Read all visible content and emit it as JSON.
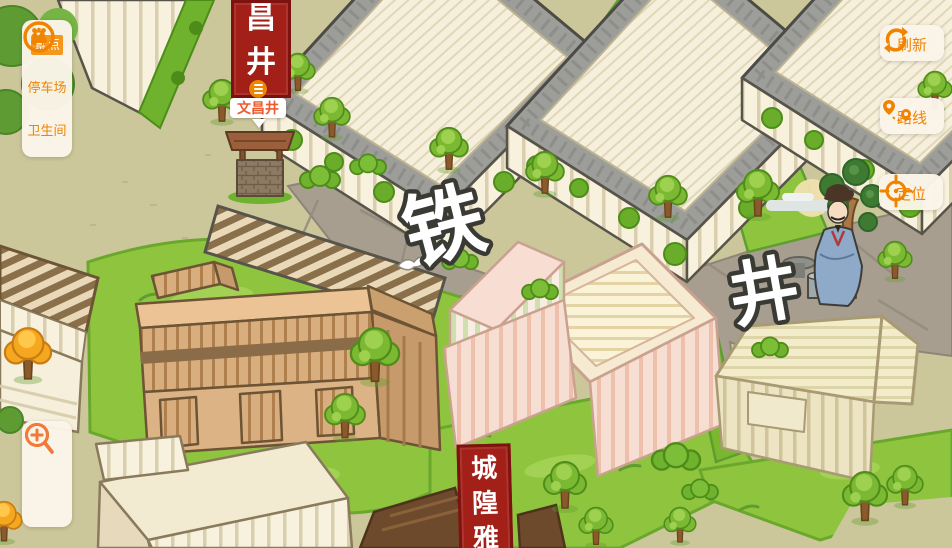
{
  "colors": {
    "accent": "#f08300",
    "accent_selected_bg": "#f5961f",
    "panel_bg": "#fbf5e9",
    "banner_red": "#a32018",
    "banner_border": "#7d120e",
    "poi_label_text": "#ef5a2d",
    "ground_khaki": "#cbc79a",
    "grass_green": "#8fc43f",
    "road_gray": "#a89e90"
  },
  "sidebar": {
    "items": [
      {
        "label": "景点",
        "icon": "scenic-spots-icon",
        "selected": true
      },
      {
        "label": "停车场",
        "icon": "parking-icon",
        "selected": false
      },
      {
        "label": "卫生间",
        "icon": "restroom-icon",
        "selected": false
      }
    ]
  },
  "zoom_controls": {
    "buttons": [
      {
        "icon": "zoom-in-icon"
      },
      {
        "icon": "zoom-out-icon"
      }
    ]
  },
  "right_controls": {
    "buttons": [
      {
        "label": "刷新",
        "icon": "refresh-icon"
      },
      {
        "label": "路线",
        "icon": "route-icon"
      },
      {
        "label": "定位",
        "icon": "locate-icon"
      }
    ]
  },
  "map": {
    "street_labels": [
      {
        "text": "铁"
      },
      {
        "text": "井"
      }
    ],
    "poi": {
      "label": "文昌井",
      "banner_text": "昌井"
    },
    "bottom_banner_text": "城隍雅"
  }
}
